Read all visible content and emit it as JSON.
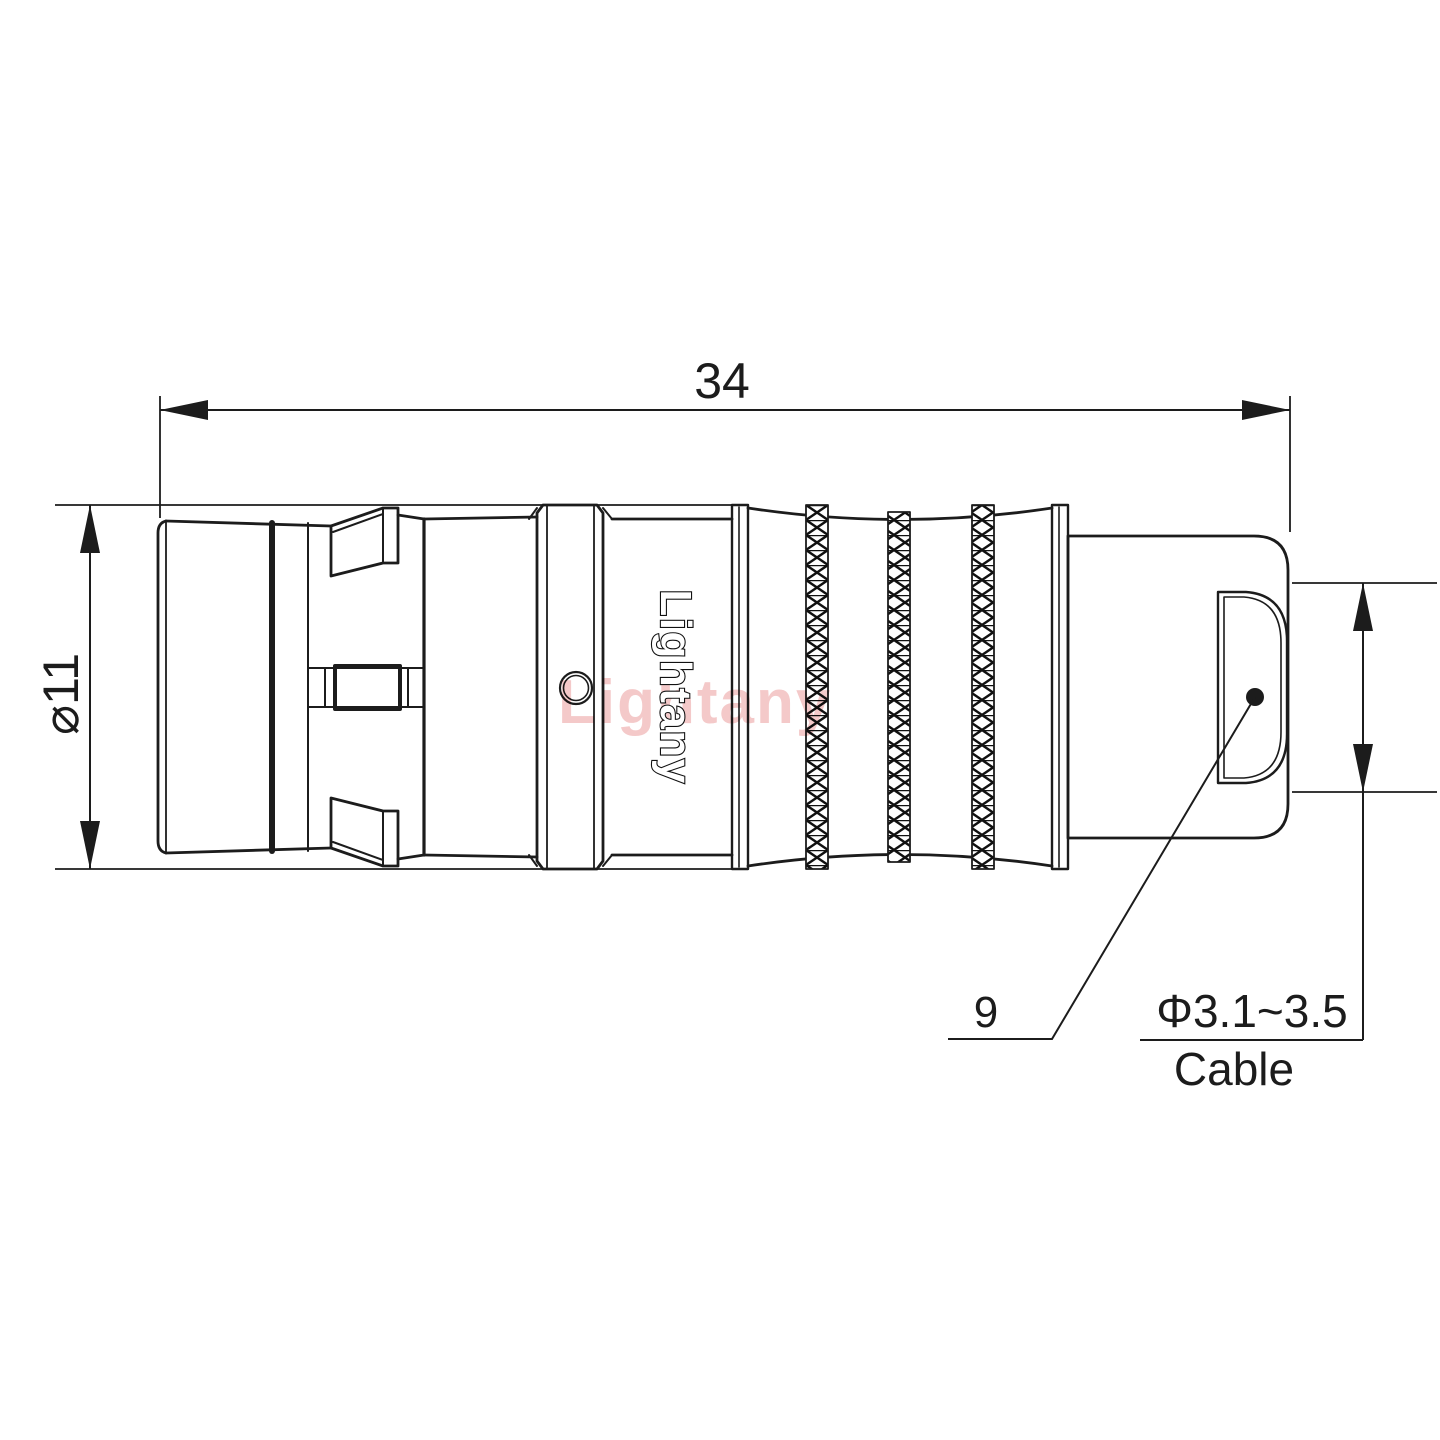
{
  "drawing": {
    "dimensions": {
      "overall_length": "34",
      "outer_diameter": "⌀11",
      "rear_dim": "9",
      "cable_diameter_range": "Φ3.1~3.5",
      "cable_label": "Cable"
    },
    "branding": {
      "body_text": "Lightany",
      "watermark_text": "Lightany"
    },
    "colors": {
      "line_color": "#1c1c1c",
      "watermark_color": "#f3c3c3",
      "background": "#ffffff"
    }
  }
}
